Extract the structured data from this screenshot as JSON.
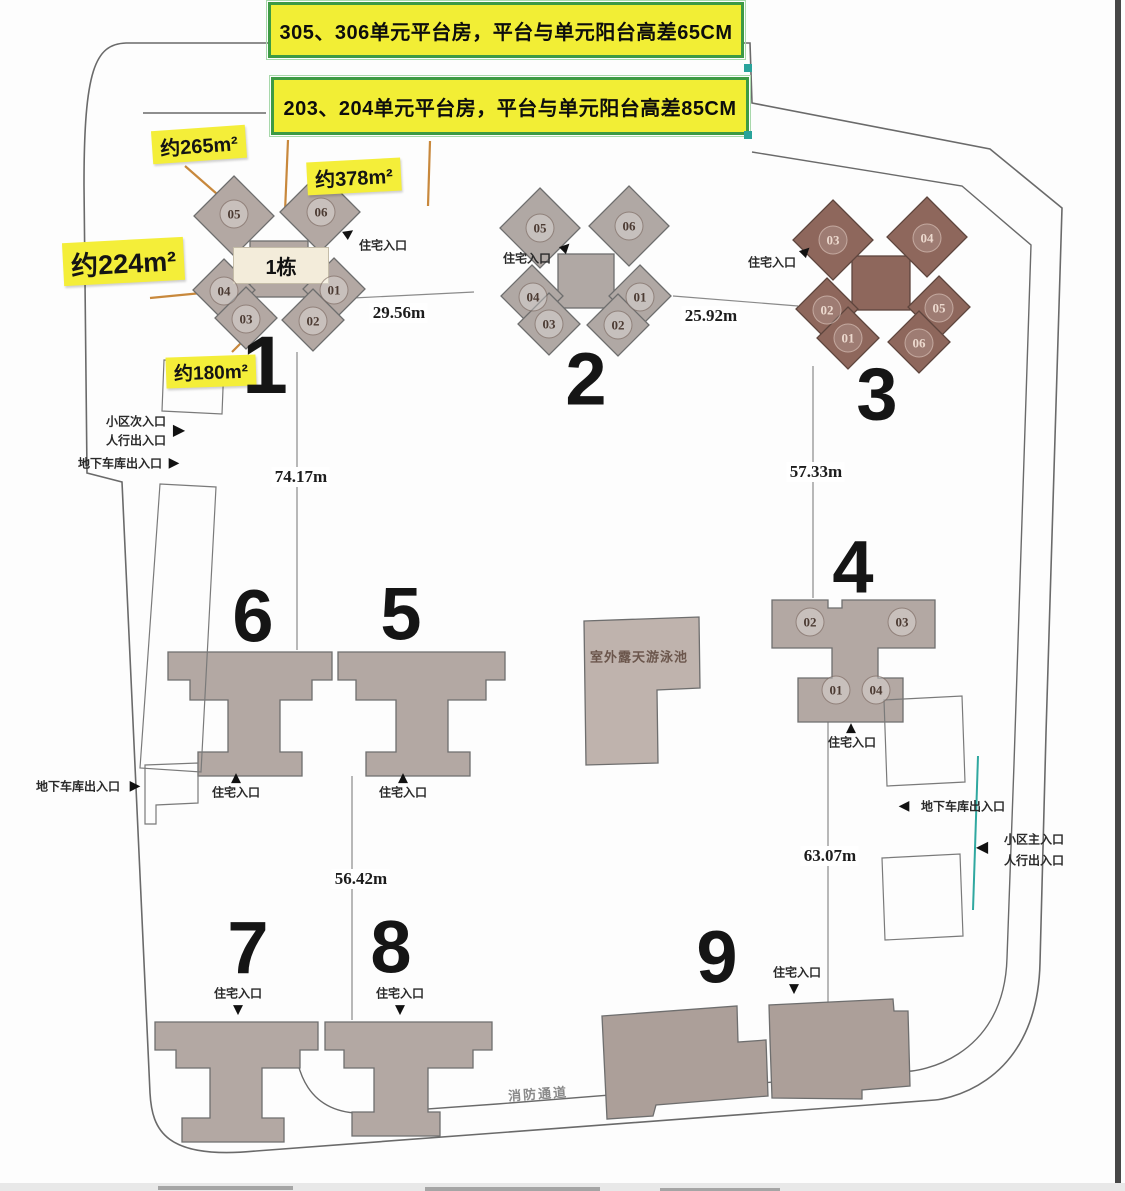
{
  "banners": {
    "b1": "305、306单元平台房，平台与单元阳台高差65CM",
    "b2": "203、204单元平台房，平台与单元阳台高差85CM"
  },
  "area_labels": {
    "a265": "约265m²",
    "a378": "约378m²",
    "a224": "约224m²",
    "a180": "约180m²"
  },
  "buildings": {
    "b1": {
      "number": "1",
      "band": "1栋",
      "units": {
        "u05": "05",
        "u06": "06",
        "u04": "04",
        "u03": "03",
        "u01": "01",
        "u02": "02"
      }
    },
    "b2": {
      "number": "2",
      "units": {
        "u05": "05",
        "u06": "06",
        "u04": "04",
        "u03": "03",
        "u01": "01",
        "u02": "02"
      }
    },
    "b3": {
      "number": "3",
      "units": {
        "u03": "03",
        "u04": "04",
        "u02": "02",
        "u01": "01",
        "u05": "05",
        "u06": "06"
      }
    },
    "b4": {
      "number": "4",
      "units": {
        "u02": "02",
        "u03": "03",
        "u01": "01",
        "u04": "04"
      }
    },
    "b5": {
      "number": "5"
    },
    "b6": {
      "number": "6"
    },
    "b7": {
      "number": "7"
    },
    "b8": {
      "number": "8"
    },
    "b9": {
      "number": "9"
    }
  },
  "labels": {
    "pool": "室外露天游泳池",
    "fire_lane": "消防通道",
    "residential_entrance": "住宅入口",
    "secondary_entrance": "小区次入口",
    "pedestrian_exit": "人行出入口",
    "garage_exit": "地下车库出入口",
    "main_entrance": "小区主入口"
  },
  "dimensions": {
    "d_1_2": "29.56m",
    "d_2_3": "25.92m",
    "d_1_6": "74.17m",
    "d_3_4": "57.33m",
    "d_5_8": "56.42m",
    "d_4_9": "63.07m"
  },
  "icons": {
    "tri_up": "▲",
    "tri_down": "▼",
    "tri_left": "◀",
    "tri_right": "▶"
  },
  "colors": {
    "banner_yellow": "#f2ee35",
    "banner_border_green": "#3d9a44",
    "building_taupe": "#b3a8a3",
    "building_dark_brown": "#8e675c",
    "pool_gray": "#bfb3ad",
    "leader_orange": "#c8883c",
    "teal_line": "#2fa8a0"
  }
}
